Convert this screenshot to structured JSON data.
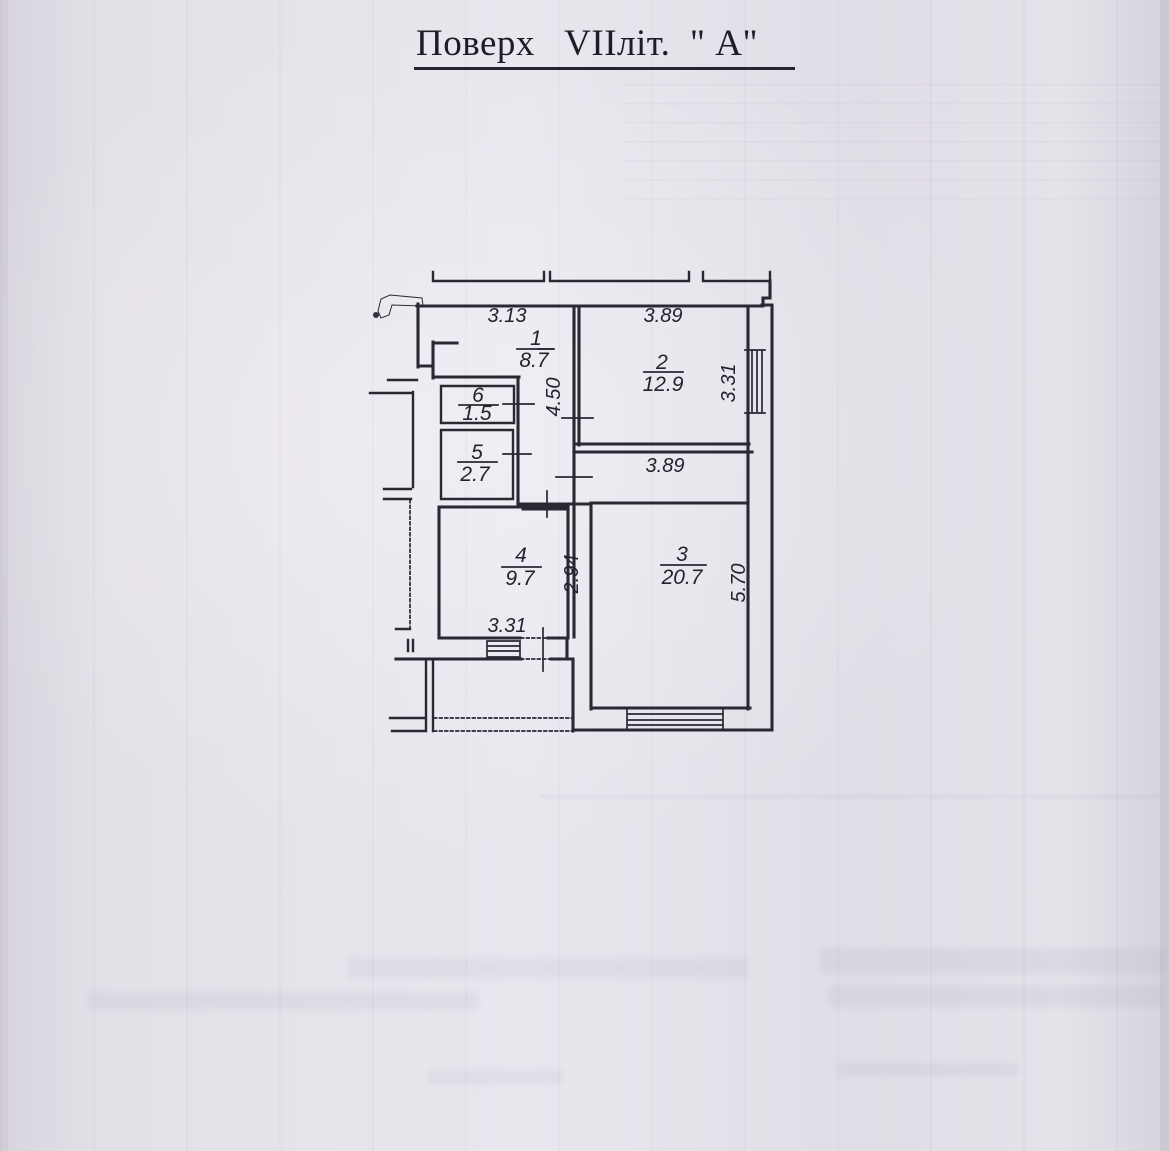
{
  "title": "Поверх   VIIліт.  \" А\"",
  "floorplan": {
    "rooms": [
      {
        "number": "1",
        "area": "8.7"
      },
      {
        "number": "2",
        "area": "12.9"
      },
      {
        "number": "3",
        "area": "20.7"
      },
      {
        "number": "4",
        "area": "9.7"
      },
      {
        "number": "5",
        "area": "2.7"
      },
      {
        "number": "6",
        "area": "1.5"
      }
    ],
    "dimensions": {
      "room1_width": "3.13",
      "room2_width": "3.89",
      "hall_length": "4.50",
      "room2_window_height": "3.31",
      "room3_width": "3.89",
      "room4_depth": "2.94",
      "room3_depth": "5.70",
      "room4_width": "3.31"
    },
    "colors": {
      "ink": "#2a2833",
      "paper": "#e4e0e7"
    }
  }
}
